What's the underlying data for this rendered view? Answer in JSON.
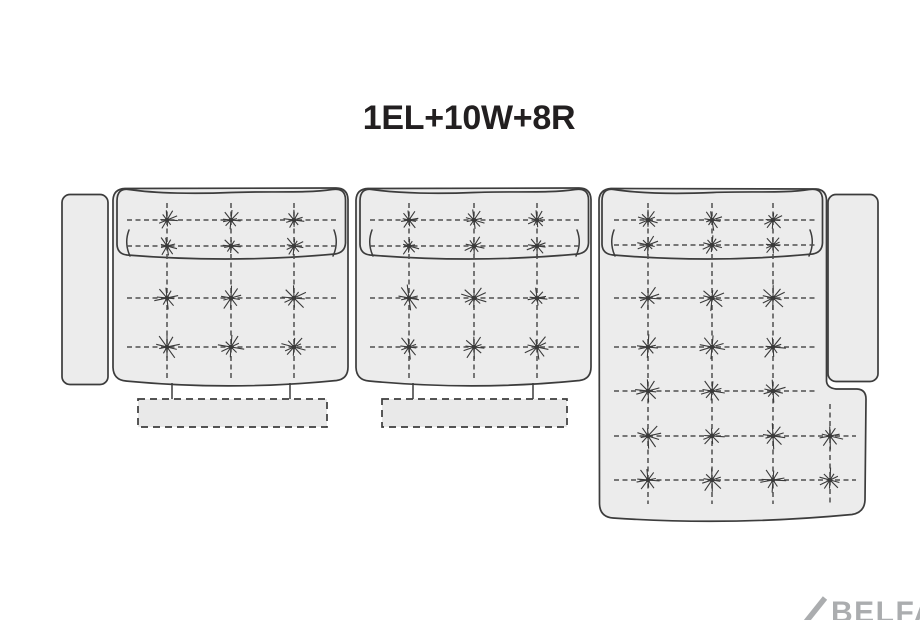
{
  "title": "1EL+10W+8R",
  "watermark": {
    "slash": "/",
    "text": "BELFA"
  },
  "colors": {
    "background": "#ffffff",
    "sofa_fill": "#ececec",
    "sofa_outline": "#3c3c3c",
    "dash_line": "#4f4f4f",
    "tuft": "#3a3a3a",
    "title_text": "#221f20",
    "watermark_text": "#abadaf",
    "footrest_fill": "#e9e9e9"
  },
  "diagram": {
    "canvas": {
      "width": 920,
      "height": 620
    },
    "button_radius": {
      "back": 10.5,
      "seat": 13
    },
    "sections": [
      {
        "name": "armless-seat-left-1el",
        "cols": [
          167,
          231,
          294
        ],
        "rows_back": [
          220,
          246
        ],
        "rows_seat": [
          298,
          347
        ],
        "row_x": [
          127,
          337
        ],
        "col_y": [
          203,
          381
        ]
      },
      {
        "name": "armless-seat-middle-10w",
        "cols": [
          409,
          474,
          537
        ],
        "rows_back": [
          220,
          246
        ],
        "rows_seat": [
          298,
          347
        ],
        "row_x": [
          370,
          579
        ],
        "col_y": [
          203,
          381
        ]
      },
      {
        "name": "chaise-right-8r",
        "cols": [
          648,
          712,
          773
        ],
        "rows_back": [
          220,
          245
        ],
        "rows_seat": [
          298,
          347,
          391,
          436,
          480
        ],
        "row_x": [
          614,
          817
        ],
        "col_y": [
          203,
          504
        ],
        "extra": {
          "col": 830,
          "rows": [
            436,
            480
          ],
          "col_y": [
            404,
            504
          ],
          "row_x2": 856
        }
      }
    ],
    "footrests": [
      {
        "rect": [
          138,
          399,
          189,
          28
        ],
        "connector_x": [
          172,
          290
        ],
        "connector_y": [
          383,
          400
        ]
      },
      {
        "rect": [
          382,
          399,
          185,
          28
        ],
        "connector_x": [
          413,
          533
        ],
        "connector_y": [
          383,
          400
        ]
      }
    ]
  }
}
